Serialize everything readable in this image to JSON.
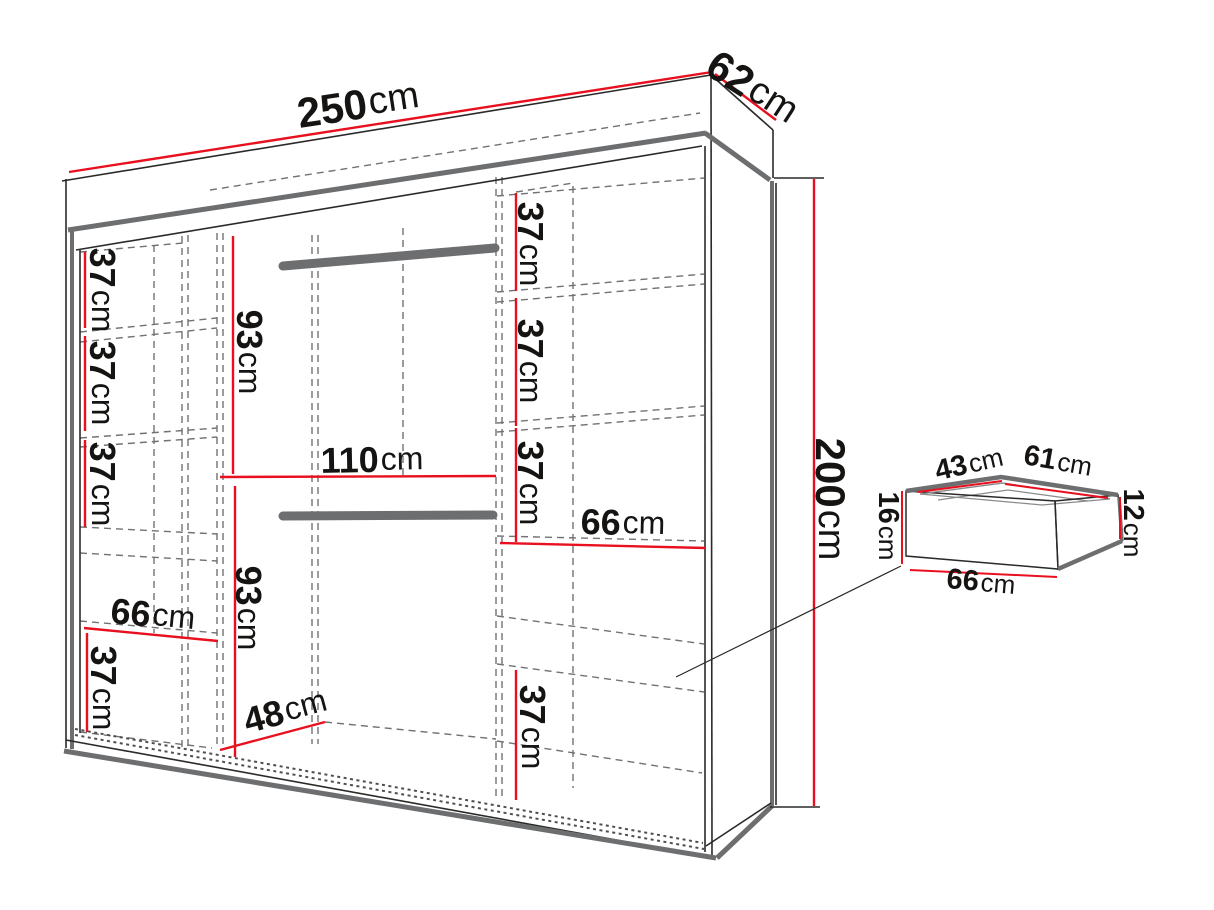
{
  "diagram": {
    "colors": {
      "dimension_line": "#e8101e",
      "structure_gray": "#6d6e70",
      "outline": "#2a2a28",
      "dashed_line": "#717275",
      "text": "#161412",
      "background": "#ffffff"
    },
    "wardrobe": {
      "width": {
        "value": "250",
        "unit": "cm"
      },
      "depth": {
        "value": "62",
        "unit": "cm"
      },
      "height": {
        "value": "200",
        "unit": "cm"
      },
      "left_column": {
        "shelf_space_1": {
          "value": "37",
          "unit": "cm"
        },
        "shelf_space_2": {
          "value": "37",
          "unit": "cm"
        },
        "shelf_space_3": {
          "value": "37",
          "unit": "cm"
        },
        "shelf_width": {
          "value": "66",
          "unit": "cm"
        },
        "shelf_space_4": {
          "value": "37",
          "unit": "cm"
        }
      },
      "middle_column": {
        "upper_hanging_height": {
          "value": "93",
          "unit": "cm"
        },
        "section_width": {
          "value": "110",
          "unit": "cm"
        },
        "lower_hanging_height": {
          "value": "93",
          "unit": "cm"
        },
        "base_depth": {
          "value": "48",
          "unit": "cm"
        }
      },
      "right_column": {
        "shelf_space_1": {
          "value": "37",
          "unit": "cm"
        },
        "shelf_space_2": {
          "value": "37",
          "unit": "cm"
        },
        "shelf_space_3": {
          "value": "37",
          "unit": "cm"
        },
        "shelf_width": {
          "value": "66",
          "unit": "cm"
        },
        "shelf_space_4": {
          "value": "37",
          "unit": "cm"
        }
      }
    },
    "drawer": {
      "inner_depth": {
        "value": "43",
        "unit": "cm"
      },
      "inner_width": {
        "value": "61",
        "unit": "cm"
      },
      "front_height": {
        "value": "16",
        "unit": "cm"
      },
      "inner_height": {
        "value": "12",
        "unit": "cm"
      },
      "outer_width": {
        "value": "66",
        "unit": "cm"
      }
    }
  }
}
